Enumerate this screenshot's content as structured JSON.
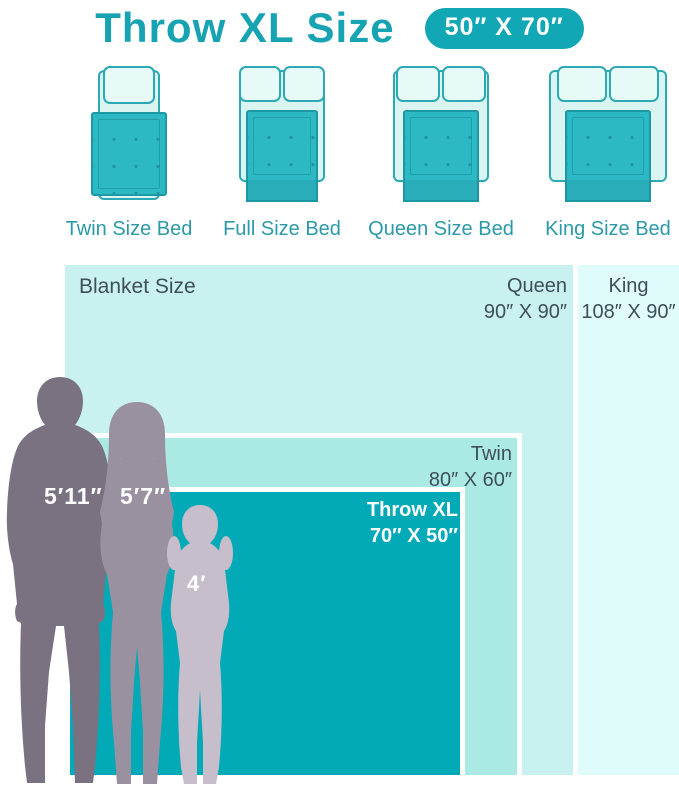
{
  "header": {
    "title": "Throw XL Size",
    "badge": "50″ X 70″"
  },
  "beds": [
    {
      "id": "twin",
      "label": "Twin Size Bed",
      "pillows": 1
    },
    {
      "id": "full",
      "label": "Full Size Bed",
      "pillows": 2
    },
    {
      "id": "queen",
      "label": "Queen Size Bed",
      "pillows": 2
    },
    {
      "id": "king",
      "label": "King Size Bed",
      "pillows": 2
    }
  ],
  "chart": {
    "heading": "Blanket Size",
    "blankets": [
      {
        "name": "King",
        "size": "108″ X 90″",
        "width_in": 108,
        "height_in": 90,
        "color": "#dffbfa"
      },
      {
        "name": "Queen",
        "size": "90″ X 90″",
        "width_in": 90,
        "height_in": 90,
        "color": "#c9f1ef"
      },
      {
        "name": "Twin",
        "size": "80″ X 60″",
        "width_in": 80,
        "height_in": 60,
        "color": "#abe9e4"
      },
      {
        "name": "Throw XL",
        "size": "70″ X 50″",
        "width_in": 70,
        "height_in": 50,
        "color": "#02a9b7"
      }
    ]
  },
  "people": [
    {
      "id": "man",
      "height": "5′11″",
      "color": "#7a7280"
    },
    {
      "id": "woman",
      "height": "5′7″",
      "color": "#9a91a0"
    },
    {
      "id": "girl",
      "height": "4′",
      "color": "#c6beca"
    }
  ],
  "colors": {
    "accent_teal": "#17a3b1",
    "badge_bg": "#12a7b5",
    "bed_outline": "#2ba9b4",
    "bed_frame_fill": "#d9f4f1",
    "bed_blanket_fill": "#2db9c3",
    "dark_text": "#3e4f5b"
  }
}
